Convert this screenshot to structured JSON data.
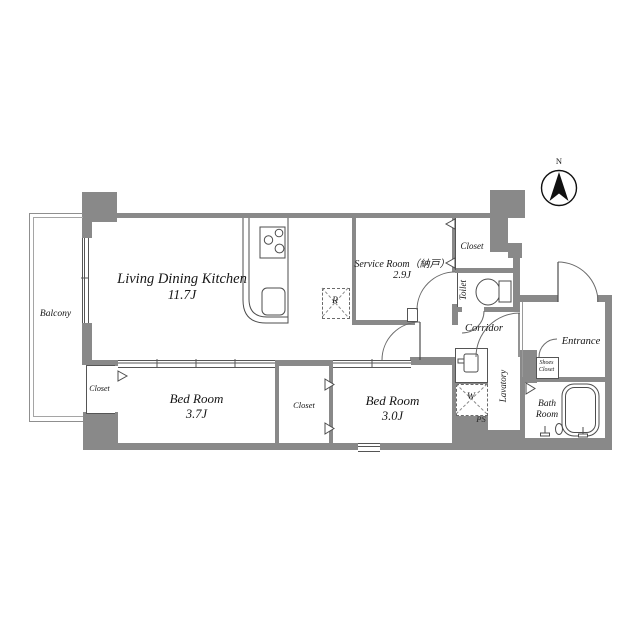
{
  "colors": {
    "wall": "#898989",
    "line": "#4d4d4d",
    "text": "#151515"
  },
  "compass": {
    "north_label": "N"
  },
  "labels": {
    "balcony": "Balcony",
    "ldk_name": "Living Dining Kitchen",
    "ldk_size": "11.7J",
    "service_name": "Service Room（納戸）",
    "service_size": "2.9J",
    "closet_top": "Closet",
    "toilet": "Toilet",
    "corridor": "Corridor",
    "entrance": "Entrance",
    "shoes_line1": "Shoes",
    "shoes_line2": "Closet",
    "lavatory": "Lavatory",
    "washer": "W",
    "ps": "PS",
    "fridge": "R",
    "bath_line1": "Bath",
    "bath_line2": "Room",
    "closet_left": "Closet",
    "bed1_name": "Bed Room",
    "bed1_size": "3.7J",
    "closet_mid": "Closet",
    "bed2_name": "Bed Room",
    "bed2_size": "3.0J"
  }
}
